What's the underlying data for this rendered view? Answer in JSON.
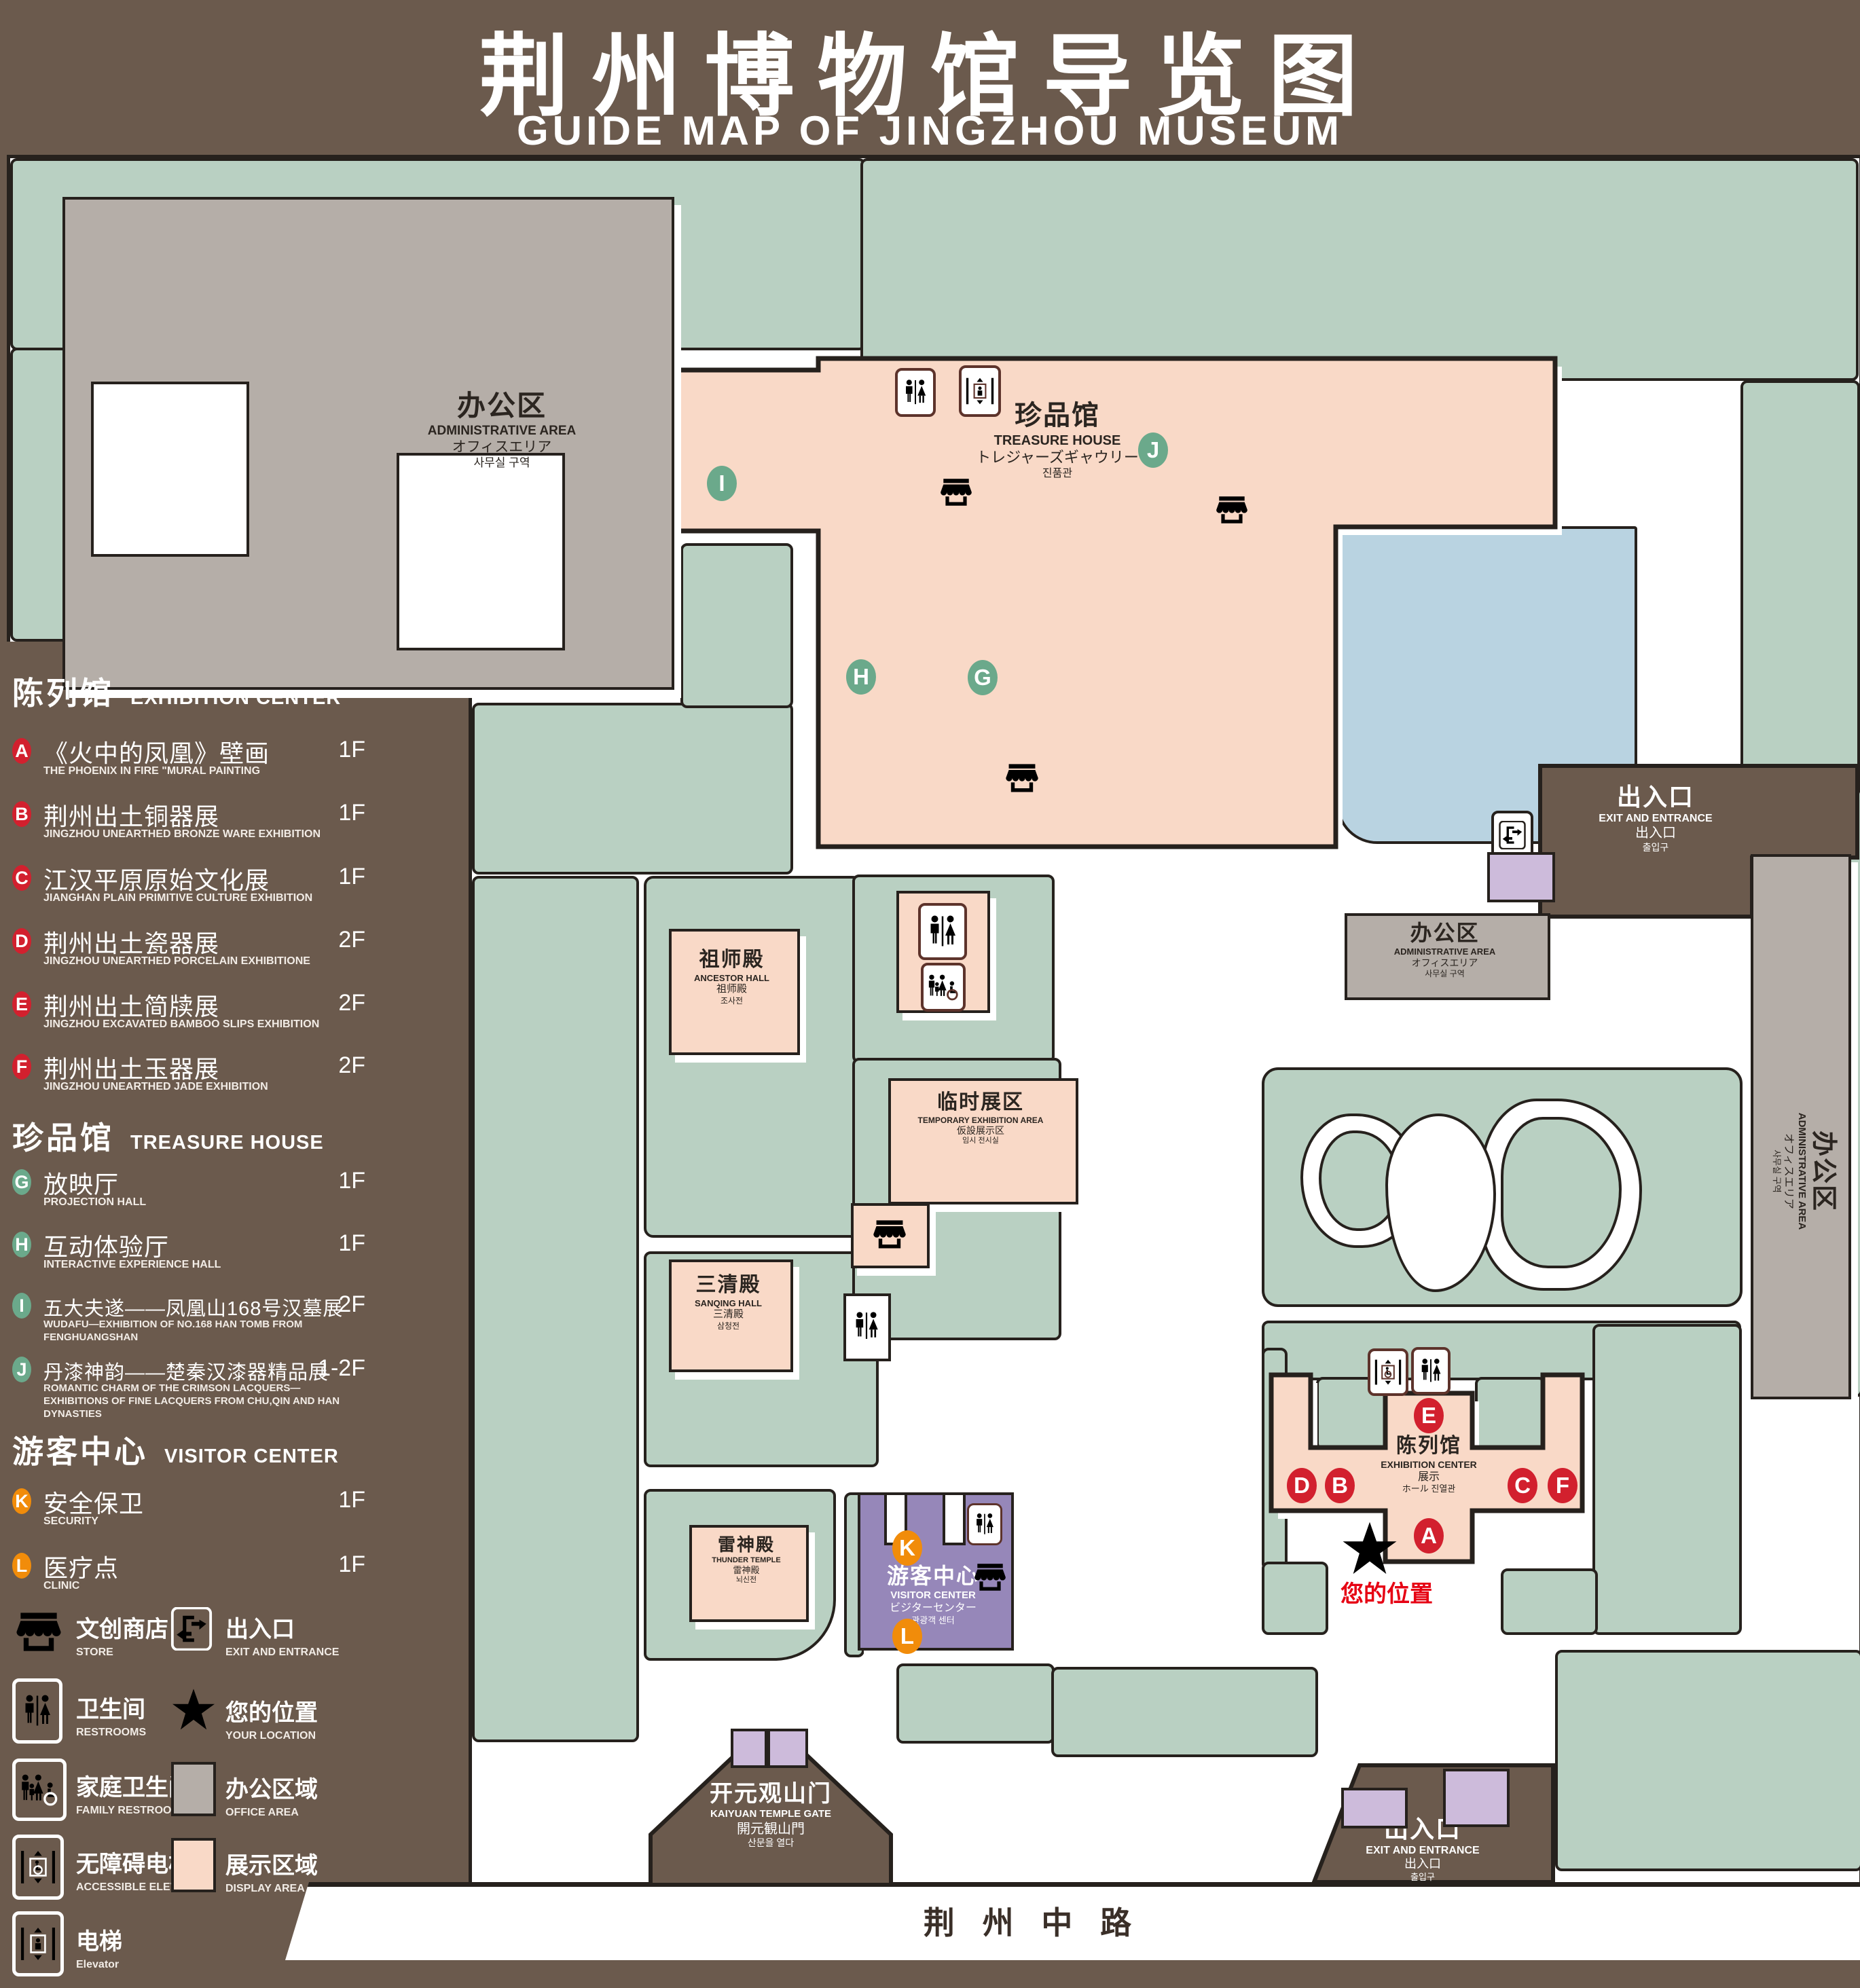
{
  "title": {
    "zh": "荆州博物馆导览图",
    "en": "GUIDE MAP OF JINGZHOU MUSEUM"
  },
  "colors": {
    "background": "#6b5a4d",
    "lawn": "#b9d0c2",
    "display_area": "#f9d9c7",
    "office_area": "#b5aea8",
    "water": "#b9d3e1",
    "visitor_center": "#9687b9",
    "entrance_block": "#cdbbdb",
    "badge_red": "#d2202e",
    "badge_green": "#6ba98b",
    "badge_orange": "#f18c0a",
    "location_red": "#e60113",
    "icon_brown": "#5d332b"
  },
  "legend": {
    "sections": [
      {
        "zh": "陈列馆",
        "en": "EXHIBITION CENTER",
        "items": [
          {
            "letter": "A",
            "zh": "《火中的凤凰》壁画",
            "en": "THE PHOENIX IN FIRE \"MURAL PAINTING",
            "floor": "1F"
          },
          {
            "letter": "B",
            "zh": "荆州出土铜器展",
            "en": "JINGZHOU UNEARTHED BRONZE WARE EXHIBITION",
            "floor": "1F"
          },
          {
            "letter": "C",
            "zh": "江汉平原原始文化展",
            "en": "JIANGHAN PLAIN PRIMITIVE CULTURE EXHIBITION",
            "floor": "1F"
          },
          {
            "letter": "D",
            "zh": "荆州出土瓷器展",
            "en": "JINGZHOU UNEARTHED PORCELAIN EXHIBITIONE",
            "floor": "2F"
          },
          {
            "letter": "E",
            "zh": "荆州出土简牍展",
            "en": "JINGZHOU EXCAVATED BAMBOO SLIPS EXHIBITION",
            "floor": "2F"
          },
          {
            "letter": "F",
            "zh": "荆州出土玉器展",
            "en": "JINGZHOU UNEARTHED JADE EXHIBITION",
            "floor": "2F"
          }
        ]
      },
      {
        "zh": "珍品馆",
        "en": "TREASURE HOUSE",
        "items": [
          {
            "letter": "G",
            "zh": "放映厅",
            "en": "PROJECTION HALL",
            "floor": "1F"
          },
          {
            "letter": "H",
            "zh": "互动体验厅",
            "en": "INTERACTIVE EXPERIENCE HALL",
            "floor": "1F"
          },
          {
            "letter": "I",
            "zh": "五大夫遂——凤凰山168号汉墓展",
            "en": "WUDAFU—EXHIBITION OF NO.168 HAN TOMB FROM FENGHUANGSHAN",
            "floor": "2F"
          },
          {
            "letter": "J",
            "zh": "丹漆神韵——楚秦汉漆器精品展",
            "en": "ROMANTIC CHARM OF THE CRIMSON LACQUERS—EXHIBITIONS OF FINE LACQUERS FROM CHU,QIN AND HAN DYNASTIES",
            "floor": "1-2F"
          }
        ]
      },
      {
        "zh": "游客中心",
        "en": "VISITOR CENTER",
        "items": [
          {
            "letter": "K",
            "zh": "安全保卫",
            "en": "SECURITY",
            "floor": "1F"
          },
          {
            "letter": "L",
            "zh": "医疗点",
            "en": "CLINIC",
            "floor": "1F"
          }
        ]
      }
    ],
    "symbols_left": [
      {
        "zh": "文创商店",
        "en": "STORE"
      },
      {
        "zh": "卫生间",
        "en": "RESTROOMS"
      },
      {
        "zh": "家庭卫生间",
        "en": "FAMILY RESTROOMS"
      },
      {
        "zh": "无障碍电梯",
        "en": "ACCESSIBLE ELEVATOR"
      },
      {
        "zh": "电梯",
        "en": "Elevator"
      }
    ],
    "symbols_right": [
      {
        "zh": "出入口",
        "en": "EXIT AND ENTRANCE"
      },
      {
        "zh": "您的位置",
        "en": "YOUR LOCATION"
      },
      {
        "zh": "办公区域",
        "en": "OFFICE AREA"
      },
      {
        "zh": "展示区域",
        "en": "DISPLAY AREA"
      }
    ]
  },
  "map": {
    "admin_nw": {
      "zh": "办公区",
      "en": "ADMINISTRATIVE AREA",
      "ja": "オフィスエリア",
      "ko": "사무실 구역"
    },
    "admin_mid": {
      "zh": "办公区",
      "en": "ADMINISTRATIVE AREA",
      "ja": "オフィスエリア",
      "ko": "사무실 구역"
    },
    "admin_east": {
      "zh": "办公区",
      "en": "ADMINISTRATIVE AREA",
      "ja": "オフィスエリア",
      "ko": "사무실 구역"
    },
    "treasure_house": {
      "zh": "珍品馆",
      "en": "TREASURE HOUSE",
      "ja": "トレジャーズギャウリー",
      "ko": "진품관"
    },
    "ancestor_hall": {
      "zh": "祖师殿",
      "en": "ANCESTOR HALL",
      "ja": "祖师殿",
      "ko": "조사전"
    },
    "sanqing_hall": {
      "zh": "三清殿",
      "en": "SANQING HALL",
      "ja": "三清殿",
      "ko": "삼청전"
    },
    "thunder_temple": {
      "zh": "雷神殿",
      "en": "THUNDER TEMPLE",
      "ja": "雷神殿",
      "ko": "뇌신전"
    },
    "temporary_area": {
      "zh": "临时展区",
      "en": "TEMPORARY EXHIBITION AREA",
      "ja": "仮設展示区",
      "ko": "임시 전시실"
    },
    "visitor_center": {
      "zh": "游客中心",
      "en": "VISITOR CENTER",
      "ja": "ビジターセンター",
      "ko": "관광객 센터"
    },
    "exhibition_center": {
      "zh": "陈列馆",
      "en": "EXHIBITION CENTER",
      "ja": "展示",
      "ko": "ホール 진열관"
    },
    "exit_ne": {
      "zh": "出入口",
      "en": "EXIT AND ENTRANCE",
      "zh2": "出入口",
      "ko": "출입구"
    },
    "exit_se": {
      "zh": "出入口",
      "en": "EXIT AND ENTRANCE",
      "zh2": "出入口",
      "ko": "출입구"
    },
    "kaiyuan_gate": {
      "zh": "开元观山门",
      "en": "KAIYUAN TEMPLE GATE",
      "ja": "開元観山門",
      "ko": "산문을 열다"
    },
    "road": "荆 州 中 路",
    "your_location": "您的位置",
    "badges": {
      "a": "A",
      "b": "B",
      "c": "C",
      "d": "D",
      "e": "E",
      "f": "F",
      "g": "G",
      "h": "H",
      "i": "I",
      "j": "J",
      "k": "K",
      "l": "L"
    }
  }
}
